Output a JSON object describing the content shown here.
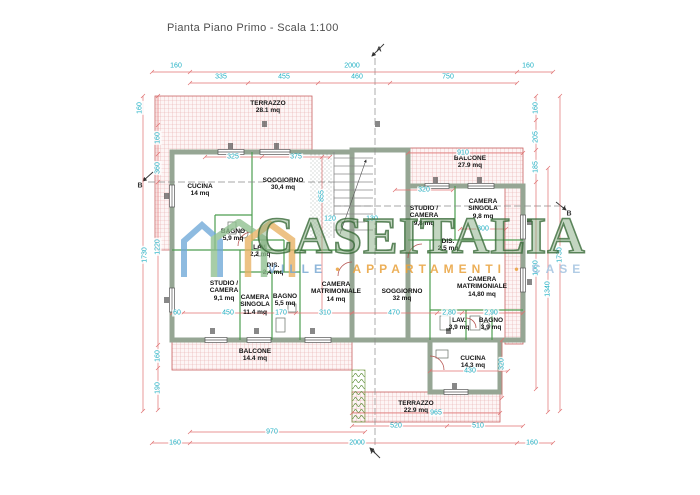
{
  "title": "Pianta Piano Primo - Scala 1:100",
  "watermark": {
    "brand": "CASEITALIA",
    "tagline_left": "VILLE",
    "tagline_mid": "APPARTAMENTI",
    "tagline_right": "CASE",
    "separator": "•"
  },
  "section_markers": {
    "top": "A",
    "bottom": "A",
    "left": "B",
    "right": "B"
  },
  "rooms": [
    {
      "name": "TERRAZZO",
      "area": "28.1 mq"
    },
    {
      "name": "CUCINA",
      "area": "14 mq"
    },
    {
      "name": "SOGGIORNO",
      "area": "30,4 mq"
    },
    {
      "name": "BAGNO",
      "area": "5,9 mq"
    },
    {
      "name": "LAV.",
      "area": "2,2 mq"
    },
    {
      "name": "DIS.",
      "area": "2,4 mq"
    },
    {
      "name": "STUDIO / CAMERA",
      "area": "9,1 mq"
    },
    {
      "name": "CAMERA SINGOLA",
      "area": "11.4 mq"
    },
    {
      "name": "BAGNO",
      "area": "5,5 mq"
    },
    {
      "name": "CAMERA MATRIMONIALE",
      "area": "14 mq"
    },
    {
      "name": "BALCONE",
      "area": "14.4 mq"
    },
    {
      "name": "BALCONE",
      "area": "27.9 mq"
    },
    {
      "name": "STUDIO / CAMERA",
      "area": "9,8 mq"
    },
    {
      "name": "CAMERA SINGOLA",
      "area": "9,8 mq"
    },
    {
      "name": "DIS.",
      "area": "2,5 mq"
    },
    {
      "name": "SOGGIORNO",
      "area": "32 mq"
    },
    {
      "name": "CAMERA MATRIMONIALE",
      "area": "14,80 mq"
    },
    {
      "name": "LAV.",
      "area": "3,9 mq"
    },
    {
      "name": "BAGNO",
      "area": "3,9 mq"
    },
    {
      "name": "CUCINA",
      "area": "14,3 mq"
    },
    {
      "name": "TERRAZZO",
      "area": "22.9 mq"
    }
  ],
  "dimensions": {
    "top_outer": [
      "160",
      "2000",
      "160"
    ],
    "top_inner": [
      "335",
      "455",
      "460",
      "750"
    ],
    "left": [
      "160",
      "160",
      "360",
      "1220",
      "1730",
      "160",
      "190"
    ],
    "right": [
      "160",
      "205",
      "185",
      "1060",
      "1730",
      "1340"
    ],
    "bottom": [
      "970",
      "160",
      "2000",
      "520",
      "510",
      "160",
      "965"
    ],
    "interior": [
      "325",
      "375",
      "855",
      "320",
      "910",
      "300",
      "60",
      "450",
      "170",
      "310",
      "470",
      "2,80",
      "2,90",
      "430",
      "320",
      "120",
      "130"
    ]
  },
  "colors": {
    "dimension_text": "#1fb0c4",
    "dimension_line": "#e07070",
    "wall": "#96a694",
    "partition": "#4e9e50",
    "hatch": "#cd5f5f",
    "watermark_green": "#6f9e6a",
    "watermark_orange": "#e9a13b",
    "watermark_blue": "#7aa9d4"
  }
}
